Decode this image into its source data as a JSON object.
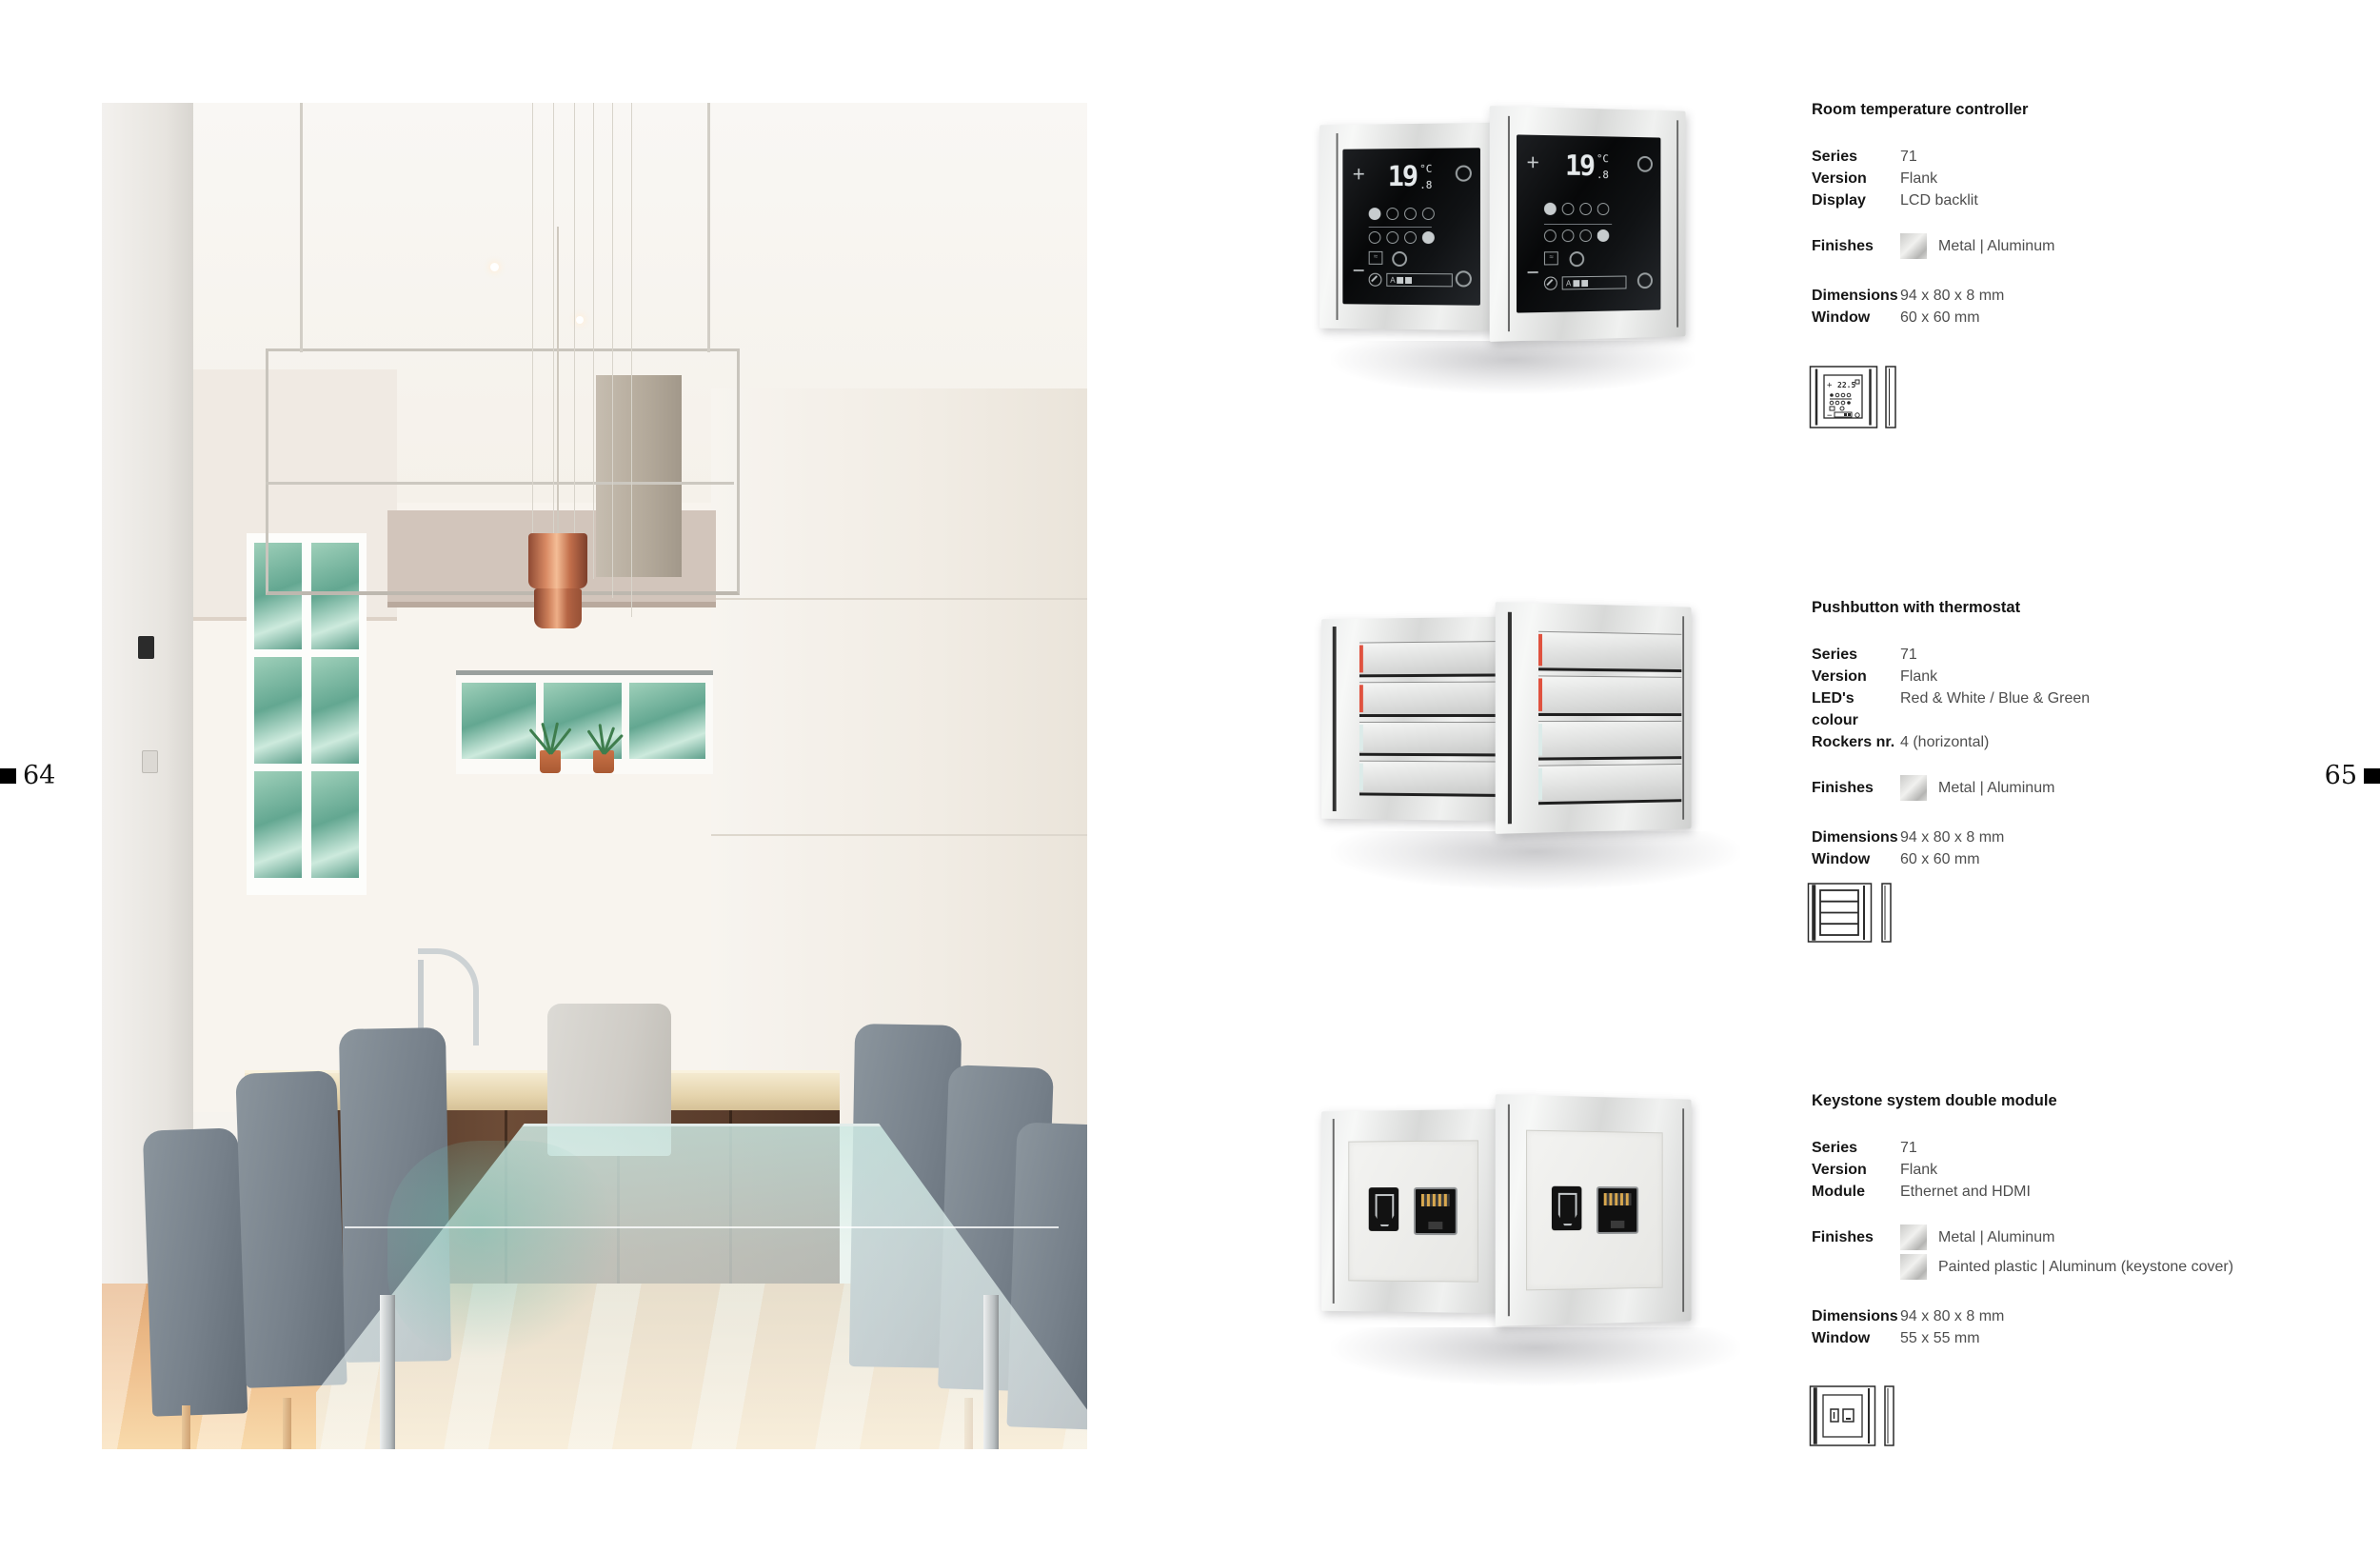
{
  "page": {
    "left_number": "64",
    "right_number": "65"
  },
  "labels": {
    "finishes": "Finishes",
    "dimensions": "Dimensions",
    "window": "Window"
  },
  "products": [
    {
      "title": "Room temperature controller",
      "specs": [
        {
          "label": "Series",
          "value": "71"
        },
        {
          "label": "Version",
          "value": "Flank"
        },
        {
          "label": "Display",
          "value": "LCD backlit"
        }
      ],
      "finishes": [
        "Metal | Aluminum"
      ],
      "dimensions": "94 x 80 x 8 mm",
      "window": "60 x 60 mm",
      "screen": {
        "temp_main": "19",
        "temp_frac": ".8",
        "unit": "°C",
        "plus": "+",
        "minus": "−",
        "auto": "A"
      },
      "icon_temp": "22.5"
    },
    {
      "title": "Pushbutton with thermostat",
      "specs": [
        {
          "label": "Series",
          "value": "71"
        },
        {
          "label": "Version",
          "value": "Flank"
        },
        {
          "label": "LED's colour",
          "value": "Red & White / Blue & Green"
        },
        {
          "label": "Rockers nr.",
          "value": "4 (horizontal)"
        }
      ],
      "finishes": [
        "Metal | Aluminum"
      ],
      "dimensions": "94 x 80 x 8 mm",
      "window": "60 x 60 mm"
    },
    {
      "title": "Keystone system double module",
      "specs": [
        {
          "label": "Series",
          "value": "71"
        },
        {
          "label": "Version",
          "value": "Flank"
        },
        {
          "label": "Module",
          "value": "Ethernet and HDMI"
        }
      ],
      "finishes": [
        "Metal | Aluminum",
        "Painted plastic | Aluminum (keystone cover)"
      ],
      "dimensions": "94 x 80 x 8 mm",
      "window": "55 x 55 mm"
    }
  ],
  "colors": {
    "led_red": "#e0523f",
    "led_cool": "#dcebe9",
    "aluminum": "#d9dad9",
    "glass_black": "#0c0e10",
    "copper_pendant": "#c97a54",
    "countertop": "#e6d7b4",
    "cabinet_wood": "#5d4030",
    "chair_gray": "#79838d",
    "foliage_green": "#63a791"
  }
}
